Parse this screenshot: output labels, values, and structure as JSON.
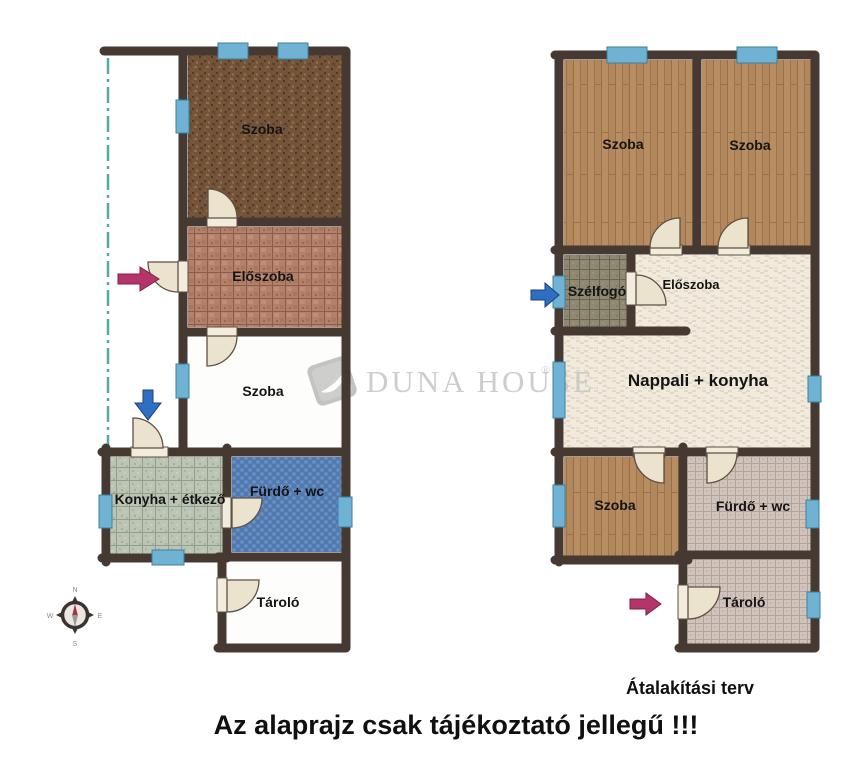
{
  "watermark": {
    "display": "DUNA HOUSE",
    "registered": "®"
  },
  "captions": {
    "right_plan": "Átalakítási terv",
    "disclaimer": "Az alaprajz csak tájékoztató jellegű !!!"
  },
  "compass": {
    "north": "N",
    "east": "E",
    "south": "S",
    "west": "W"
  },
  "plans": {
    "left": {
      "rooms": [
        {
          "label": "Szoba",
          "floor_color": "#73533a",
          "floor": "dark-carpet"
        },
        {
          "label": "Előszoba",
          "floor_color": "#b3806a",
          "floor": "terracotta-tile"
        },
        {
          "label": "Szoba",
          "floor_color": "#fdfdfb",
          "floor": "plain-white"
        },
        {
          "label": "Konyha + étkező",
          "floor_color": "#bcc4b4",
          "floor": "green-grid-tile"
        },
        {
          "label": "Fürdő + wc",
          "floor_color": "#5d85bb",
          "floor": "blue-mosaic"
        },
        {
          "label": "Tároló",
          "floor_color": "#fdfdfb",
          "floor": "plain-white"
        }
      ]
    },
    "right": {
      "rooms": [
        {
          "label": "Szoba",
          "floor_color": "#b88d61",
          "floor": "wood-planks"
        },
        {
          "label": "Szoba",
          "floor_color": "#b88d61",
          "floor": "wood-planks"
        },
        {
          "label": "Szélfogó",
          "floor_color": "#8f8873",
          "floor": "khaki-tile"
        },
        {
          "label": "Előszoba",
          "floor_color": "#f1eadd",
          "floor": "cream-parquet"
        },
        {
          "label": "Nappali + konyha",
          "floor_color": "#f1eadd",
          "floor": "cream-parquet"
        },
        {
          "label": "Szoba",
          "floor_color": "#b88d61",
          "floor": "wood-planks"
        },
        {
          "label": "Fürdő + wc",
          "floor_color": "#cfc3bb",
          "floor": "pink-grid-tile"
        },
        {
          "label": "Tároló",
          "floor_color": "#cfc3bb",
          "floor": "pink-grid-tile"
        }
      ]
    }
  },
  "arrows": [
    {
      "plan": "left",
      "direction": "right",
      "color": "#b5356b"
    },
    {
      "plan": "left",
      "direction": "down",
      "color": "#2f6fc1"
    },
    {
      "plan": "right",
      "direction": "right",
      "color": "#2f6fc1"
    },
    {
      "plan": "right",
      "direction": "right",
      "color": "#b5356b"
    }
  ],
  "colors": {
    "wall": "#463931",
    "window": "#6fb2d3",
    "door": "#ece3cf",
    "boundary_dash": "#53aca4",
    "watermark_text": "#c8c8c8"
  }
}
